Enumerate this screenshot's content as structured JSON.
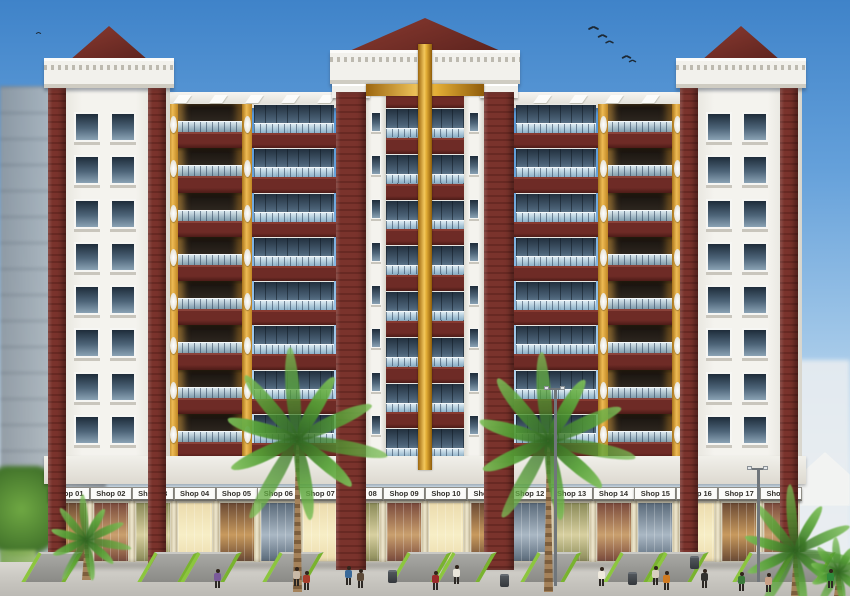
{
  "scene": {
    "description": "Architectural rendering of a symmetric multi-storey residential apartment complex with maroon brick towers, gold accent piers, glass balconies, and a row of ground-floor retail shops; palm trees and pedestrians at street level under a blue sky with birds",
    "floors_per_tower": 8,
    "shops": [
      "Shop 01",
      "Shop 02",
      "Shop 03",
      "Shop 04",
      "Shop 05",
      "Shop 06",
      "Shop 07",
      "Shop 08",
      "Shop 09",
      "Shop 10",
      "Shop 11",
      "Shop 12",
      "Shop 13",
      "Shop 14",
      "Shop 15",
      "Shop 16",
      "Shop 17",
      "Shop 18"
    ],
    "shop_palettes": [
      [
        "#6b4a34",
        "#c89a5e"
      ],
      [
        "#8a8a58",
        "#d8d0a0"
      ],
      [
        "#ecdcae",
        "#f7eec6"
      ],
      [
        "#7a4a3c",
        "#caa06e"
      ],
      [
        "#5a6a7a",
        "#aab8c4"
      ]
    ],
    "shop_palette_map": [
      0,
      3,
      1,
      2,
      0,
      4,
      2,
      1,
      3,
      2,
      0,
      4,
      1,
      3,
      4,
      2,
      0,
      3
    ],
    "colors": {
      "sky_top": "#3f83c9",
      "sky_bottom": "#e6eef5",
      "maroon": "#6e2b26",
      "gold": "#e9b344",
      "white_wall": "#f2f1ec",
      "glass": "#4c6378",
      "railing_glass": "#a9c8dc",
      "ramp_green": "#8cc63e",
      "pavement": "#cfcdc7",
      "palm_green": "#4f8f2f"
    },
    "birds": [
      {
        "x": 588,
        "y": 25,
        "s": 1
      },
      {
        "x": 597,
        "y": 33,
        "s": 0.9
      },
      {
        "x": 604,
        "y": 39,
        "s": 0.8
      },
      {
        "x": 621,
        "y": 54,
        "s": 0.9
      },
      {
        "x": 627,
        "y": 58,
        "s": 0.7
      },
      {
        "x": 566,
        "y": 118,
        "s": 0.6
      },
      {
        "x": 33,
        "y": 30,
        "s": 0.5
      }
    ],
    "people": [
      {
        "x": 213,
        "y": 588,
        "c": "#7a5a9a"
      },
      {
        "x": 292,
        "y": 586,
        "c": "#c9b9a6"
      },
      {
        "x": 302,
        "y": 590,
        "c": "#a63c2a"
      },
      {
        "x": 344,
        "y": 585,
        "c": "#3a6a9a"
      },
      {
        "x": 356,
        "y": 588,
        "c": "#5d4a38"
      },
      {
        "x": 431,
        "y": 590,
        "c": "#9a2a2a"
      },
      {
        "x": 452,
        "y": 584,
        "c": "#e9e5da"
      },
      {
        "x": 597,
        "y": 586,
        "c": "#efe9dd"
      },
      {
        "x": 651,
        "y": 585,
        "c": "#d8d0c0"
      },
      {
        "x": 662,
        "y": 590,
        "c": "#d07a20"
      },
      {
        "x": 700,
        "y": 588,
        "c": "#30302e"
      },
      {
        "x": 737,
        "y": 591,
        "c": "#3a7a3a"
      },
      {
        "x": 764,
        "y": 592,
        "c": "#c9a086"
      },
      {
        "x": 826,
        "y": 588,
        "c": "#2f8a3a"
      }
    ],
    "palms": [
      {
        "x": 297,
        "y": 436,
        "r": 88,
        "t": 156
      },
      {
        "x": 548,
        "y": 438,
        "r": 86,
        "t": 154
      },
      {
        "x": 795,
        "y": 550,
        "r": 64,
        "t": 46
      },
      {
        "x": 86,
        "y": 540,
        "r": 44,
        "t": 40
      },
      {
        "x": 838,
        "y": 572,
        "r": 34,
        "t": 24
      }
    ],
    "ramps_x": [
      30,
      146,
      189,
      271,
      399,
      444,
      529,
      612,
      656,
      741,
      783
    ],
    "bins": [
      {
        "x": 388,
        "y": 570
      },
      {
        "x": 500,
        "y": 574
      },
      {
        "x": 628,
        "y": 572
      },
      {
        "x": 690,
        "y": 556
      }
    ],
    "poles": [
      {
        "x": 554,
        "y": 388,
        "h": 198
      },
      {
        "x": 757,
        "y": 468,
        "h": 114
      }
    ]
  }
}
